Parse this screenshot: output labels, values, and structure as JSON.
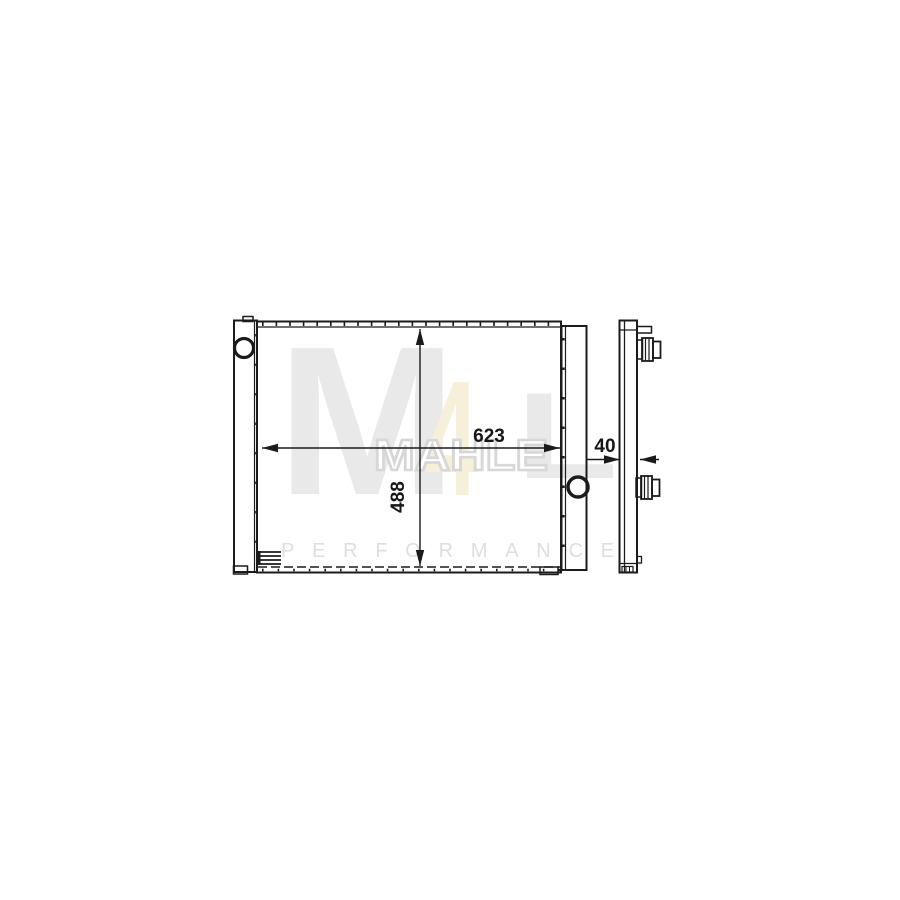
{
  "watermark": {
    "logo_m": "M",
    "logo_digit": "4",
    "logo_l": "L",
    "brand": "MAHLE",
    "tagline": "PERFORMANCE"
  },
  "dimensions": {
    "width": "623",
    "core_height": "488",
    "depth": "40"
  },
  "colors": {
    "line": "#1b1b1b",
    "dim_text": "#161616",
    "logo_gray": "#e9e9e9",
    "logo_cream": "#f6efda",
    "brand_fill": "#ffffff",
    "brand_outline": "#d7d7d7",
    "tagline": "#dedede",
    "background": "#ffffff"
  }
}
